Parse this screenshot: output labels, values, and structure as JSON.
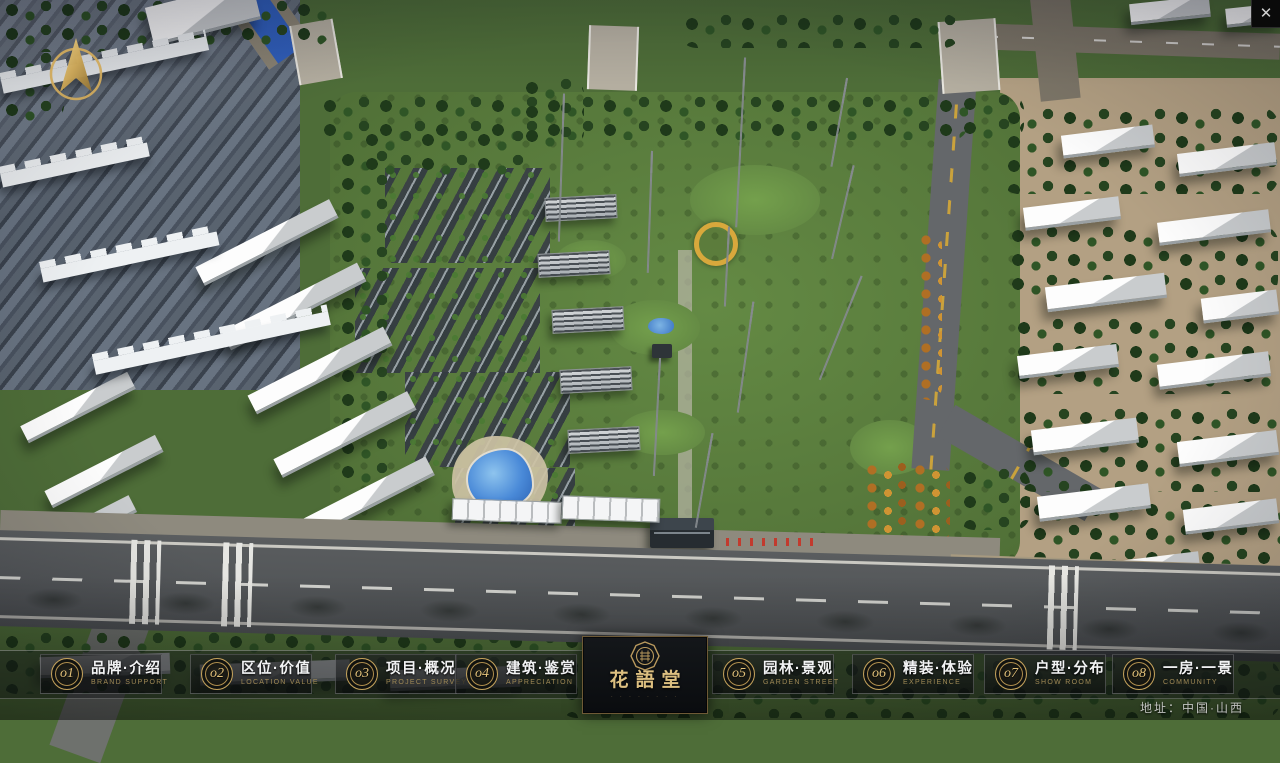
{
  "window": {
    "close": "✕"
  },
  "theme": {
    "gold": "#c9a656",
    "gold-bright": "#e3c27a",
    "gold-dim": "#a08a56",
    "bar-bg": "rgba(18,20,22,0.4)",
    "panel-border": "rgba(185,185,190,0.3)",
    "text-white": "#f2f3f4",
    "logo-bg": "#0a0c0f",
    "water": "#2d5cb5",
    "grass": "#527238",
    "asphalt": "#54575a"
  },
  "navbar": {
    "items": [
      {
        "num": "o1",
        "zh": "品牌·介绍",
        "en": "BRAND SUPPORT"
      },
      {
        "num": "o2",
        "zh": "区位·价值",
        "en": "LOCATION VALUE"
      },
      {
        "num": "o3",
        "zh": "项目·概况",
        "en": "PROJECT SURVEY"
      },
      {
        "num": "o4",
        "zh": "建筑·鉴赏",
        "en": "APPRECIATION"
      },
      {
        "num": "o5",
        "zh": "园林·景观",
        "en": "GARDEN STREET"
      },
      {
        "num": "o6",
        "zh": "精装·体验",
        "en": "EXPERIENCE"
      },
      {
        "num": "o7",
        "zh": "户型·分布",
        "en": "SHOW ROOM"
      },
      {
        "num": "o8",
        "zh": "一房·一景",
        "en": "COMMUNITY"
      }
    ]
  },
  "logo": {
    "title": "花語堂",
    "tagline": "· · · · · · · ·"
  },
  "footer": {
    "address": "地址：中国·山西"
  }
}
